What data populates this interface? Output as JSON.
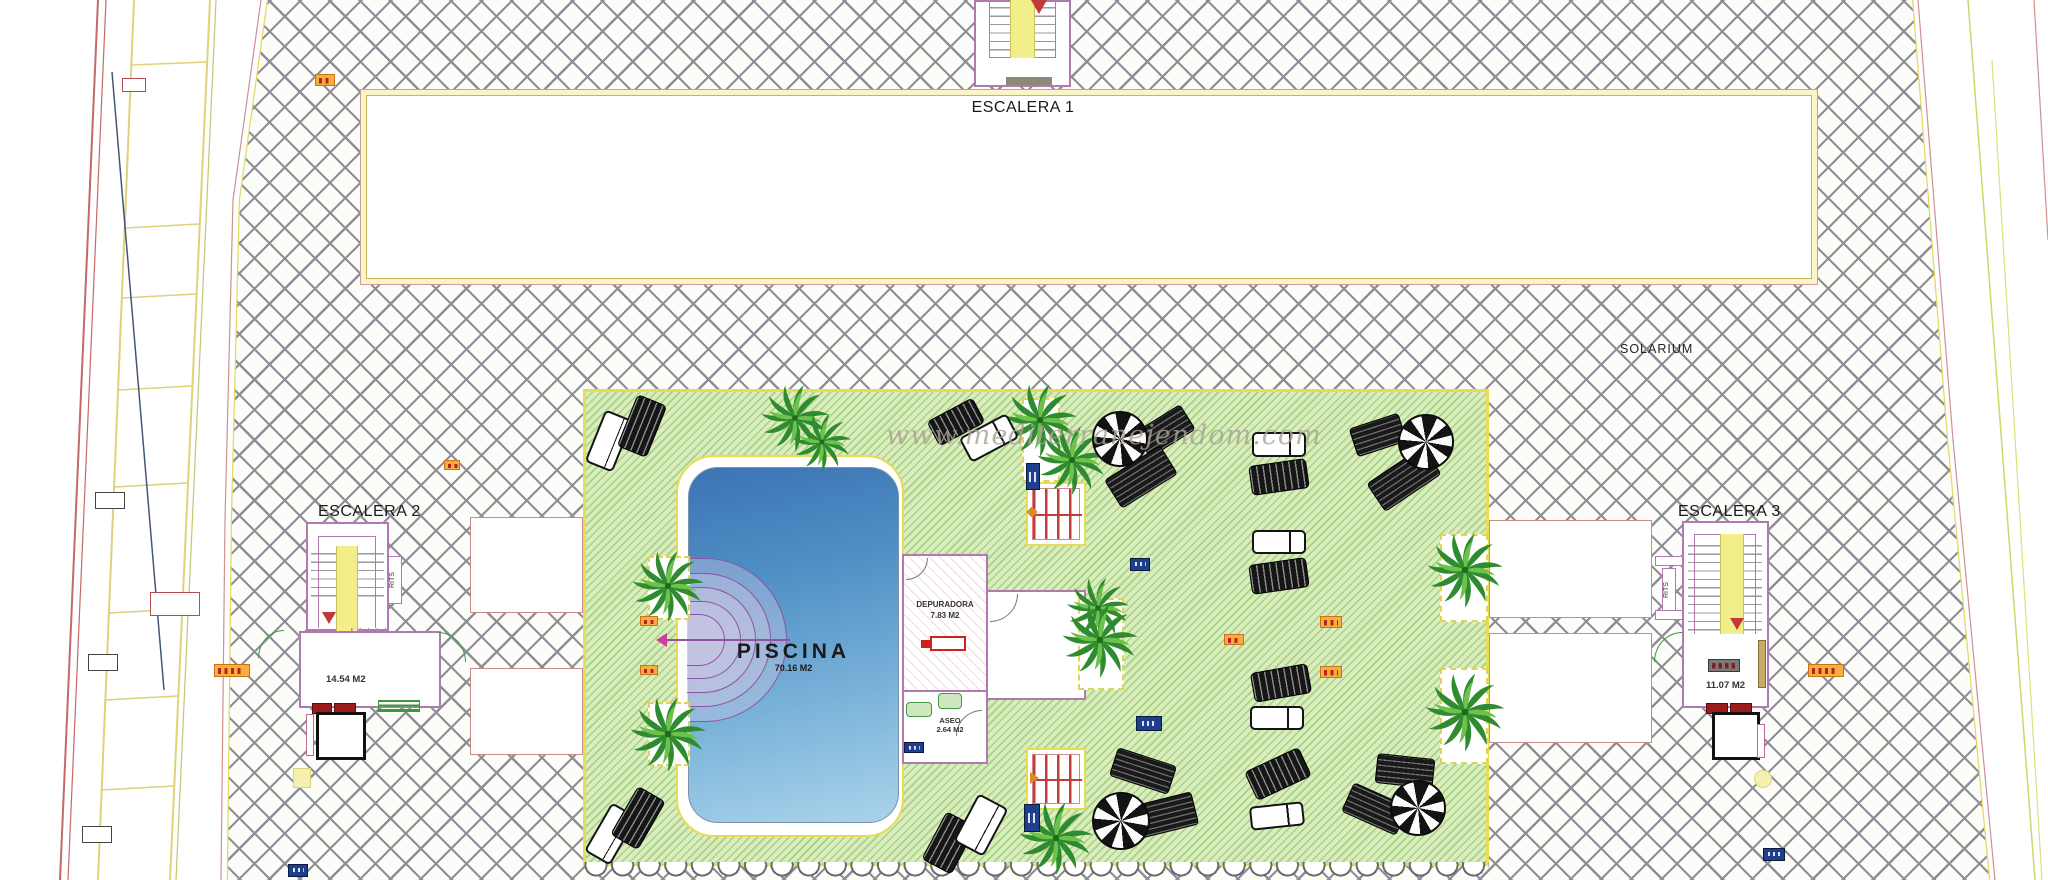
{
  "plan": {
    "watermark": "www.mediterranejendom.com",
    "deck_label": "SOLARIUM",
    "stairs": {
      "escalera1": {
        "label": "ESCALERA 1"
      },
      "escalera2": {
        "label": "ESCALERA 2",
        "area": "14.54 M2",
        "shaft_label": "RITS"
      },
      "escalera3": {
        "label": "ESCALERA 3",
        "area": "11.07 M2",
        "shaft_label": "RITS"
      }
    },
    "pool": {
      "label": "PISCINA",
      "area": "70.16 M2"
    },
    "rooms": {
      "depuradora": {
        "label": "DEPURADORA",
        "area": "7.83 M2"
      },
      "aseo": {
        "label": "ASEO",
        "area": "2.64 M2"
      }
    }
  },
  "colors": {
    "deck_hatch_line": "#8e8e97",
    "green_fill": "#d9eebc",
    "green_hatch_line": "#80b85c",
    "zone_edge_yellow": "#e7dc55",
    "wall_pink": "#b07ab0",
    "stair_yellow": "#f2ee8a",
    "pool_deep": "#3b74b4",
    "pool_shallow": "#aad3ea",
    "arrow_red": "#c03a3a",
    "marker_orange": "#f6ae3c",
    "marker_blue": "#1d3f8e"
  }
}
